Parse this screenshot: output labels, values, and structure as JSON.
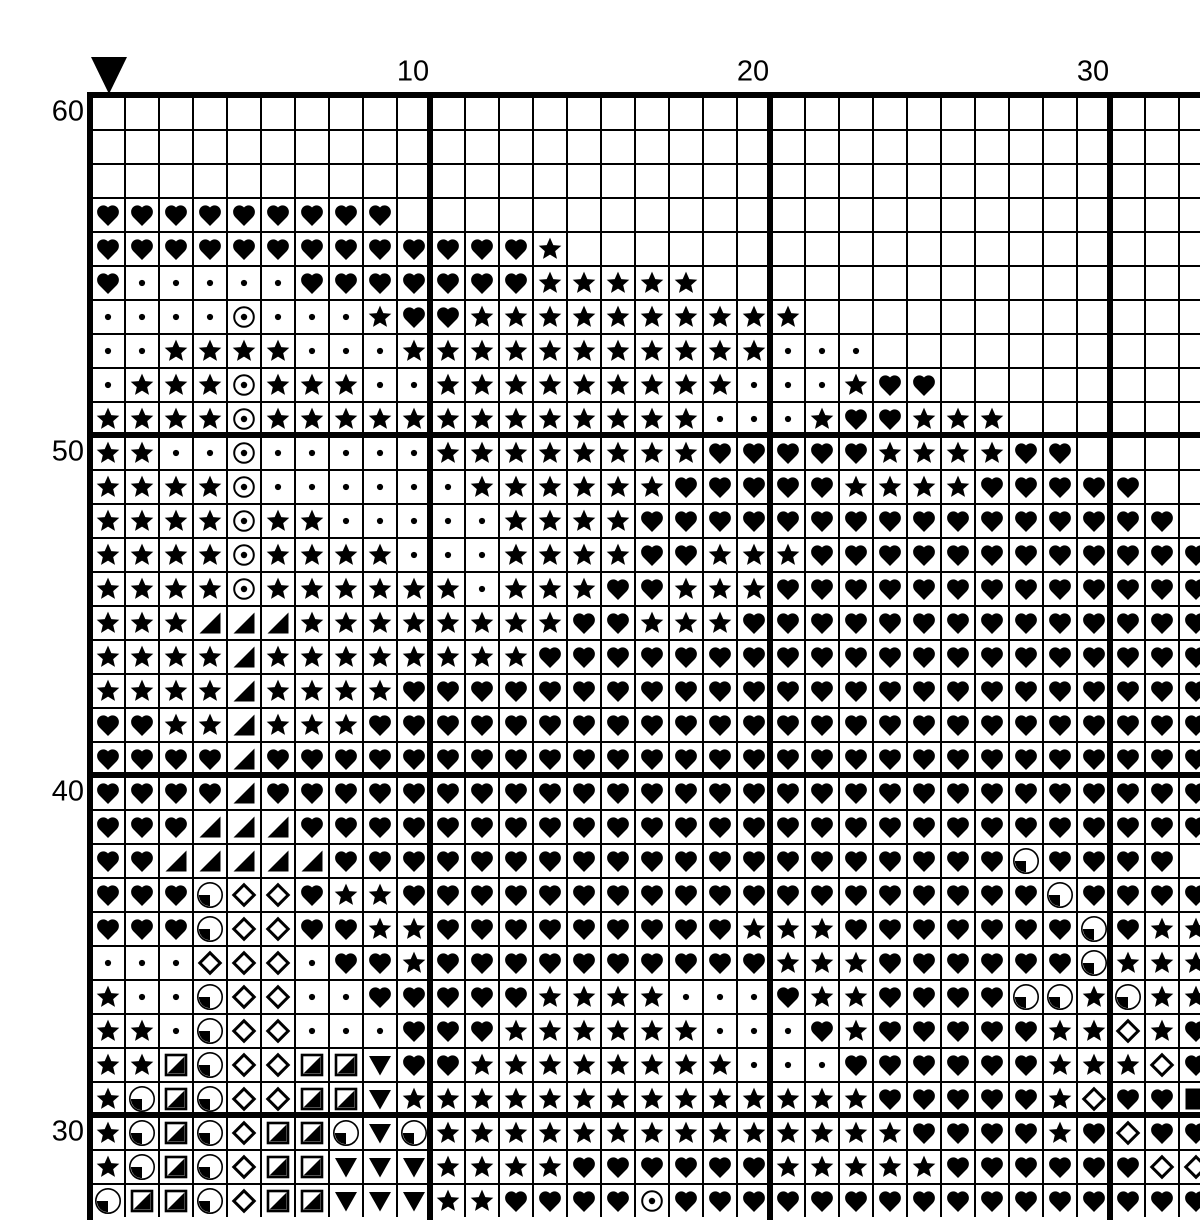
{
  "title": "cross-stitch-pattern-chart",
  "colors": {
    "background": "#ffffff",
    "grid_lines": "#000000",
    "symbols": "#000000"
  },
  "grid": {
    "origin_x": 90,
    "origin_y": 95,
    "cell_size": 34,
    "visible_columns": 33,
    "visible_rows": 33,
    "bold_line_every": 10,
    "thin_line_px": 2,
    "bold_line_px": 6,
    "first_row_number": 60,
    "last_row_number": 28,
    "column_labels": [
      {
        "value": "10",
        "column": 10
      },
      {
        "value": "20",
        "column": 20
      },
      {
        "value": "30",
        "column": 30
      }
    ],
    "row_labels": [
      {
        "value": "60",
        "row": 60
      },
      {
        "value": "50",
        "row": 50
      },
      {
        "value": "40",
        "row": 40
      },
      {
        "value": "30",
        "row": 30
      }
    ],
    "center_marker": {
      "shape": "filled-down-triangle",
      "column": 1
    }
  },
  "legend": {
    ".": "empty",
    "h": "filled-heart",
    "s": "filled-star",
    "d": "small-dot",
    "o": "circled-dot",
    "t": "lower-right-filled-triangle",
    "m": "open-diamond",
    "c": "circle-lower-left-quadrant-filled",
    "q": "square-lower-right-half-filled",
    "v": "filled-down-triangle",
    "f": "filled-square"
  },
  "pattern_rows": [
    {
      "row": 60,
      "cells": "................................."
    },
    {
      "row": 59,
      "cells": "................................."
    },
    {
      "row": 58,
      "cells": "................................."
    },
    {
      "row": 57,
      "cells": "hhhhhhhhh........................"
    },
    {
      "row": 56,
      "cells": "hhhhhhhhhhhhhs..................."
    },
    {
      "row": 55,
      "cells": "hdddddhhhhhhhsssss..............."
    },
    {
      "row": 54,
      "cells": "ddddodddshhssssssssss............"
    },
    {
      "row": 53,
      "cells": "ddssssdddsssssssssssddd.........."
    },
    {
      "row": 52,
      "cells": "dsssosssddsssssssssdddshh........"
    },
    {
      "row": 51,
      "cells": "ssssosssssssssssssdddshhsss......"
    },
    {
      "row": 50,
      "cells": "ssddodddddsssssssshhhhhsssshh...."
    },
    {
      "row": 49,
      "cells": "ssssoddddddsssssshhhhhsssshhhhh.."
    },
    {
      "row": 48,
      "cells": "ssssossdddddsssshhhhhhhhhhhhhhhh."
    },
    {
      "row": 47,
      "cells": "ssssossssdddsssshhssshhhhhhhhhhhh"
    },
    {
      "row": 46,
      "cells": "ssssossssssdssshhssshhhhhhhhhhhhh"
    },
    {
      "row": 45,
      "cells": "ssstttsssssssshhssshhhhhhhhhhhhhh"
    },
    {
      "row": 44,
      "cells": "sssstsssssssshhhhhhhhhhhhhhhhhhhh"
    },
    {
      "row": 43,
      "cells": "sssstsssshhhhhhhhhhhhhhhhhhhhhhhh"
    },
    {
      "row": 42,
      "cells": "hhsstssshhhhhhhhhhhhhhhhhhhhhhhhh"
    },
    {
      "row": 41,
      "cells": "hhhhthhhhhhhhhhhhhhhhhhhhhhhhhhhh"
    },
    {
      "row": 40,
      "cells": "hhhhthhhhhhhhhhhhhhhhhhhhhhhhhhhh"
    },
    {
      "row": 39,
      "cells": "hhhttthhhhhhhhhhhhhhhhhhhhhhhhhhh"
    },
    {
      "row": 38,
      "cells": "hhttttthhhhhhhhhhhhhhhhhhhhchhhh"
    },
    {
      "row": 37,
      "cells": "hhhcmmhsshhhhhhhhhhhhhhhhhhhchhhh"
    },
    {
      "row": 36,
      "cells": "hhhcmmhhsshhhhhhhhhssshhhhhhhchss"
    },
    {
      "row": 35,
      "cells": "dddmmmdhhshhhhhhhhhhssshhhhhhcsss"
    },
    {
      "row": 34,
      "cells": "sddcmmddhhhhhssssdddhsshhhhccscss"
    },
    {
      "row": 33,
      "cells": "ssdcmmdddhhhssssssdddhshhhhhssmsh"
    },
    {
      "row": 32,
      "cells": "ssqcmmqqvhhssssssssdddhhhhhhsssmh"
    },
    {
      "row": 31,
      "cells": "scqcmmqqvsssssssssssssshhhhhsmhhf"
    },
    {
      "row": 30,
      "cells": "scqcmqqcvcsssssssssssssshhhhshmhh"
    },
    {
      "row": 29,
      "cells": "scqcmqqvvvsssshhhhhhssssshhhhhhmm"
    },
    {
      "row": 28,
      "cells": "cqqcmqqvvvsshhhhohhhhhhhhhhhhhhhh"
    }
  ]
}
